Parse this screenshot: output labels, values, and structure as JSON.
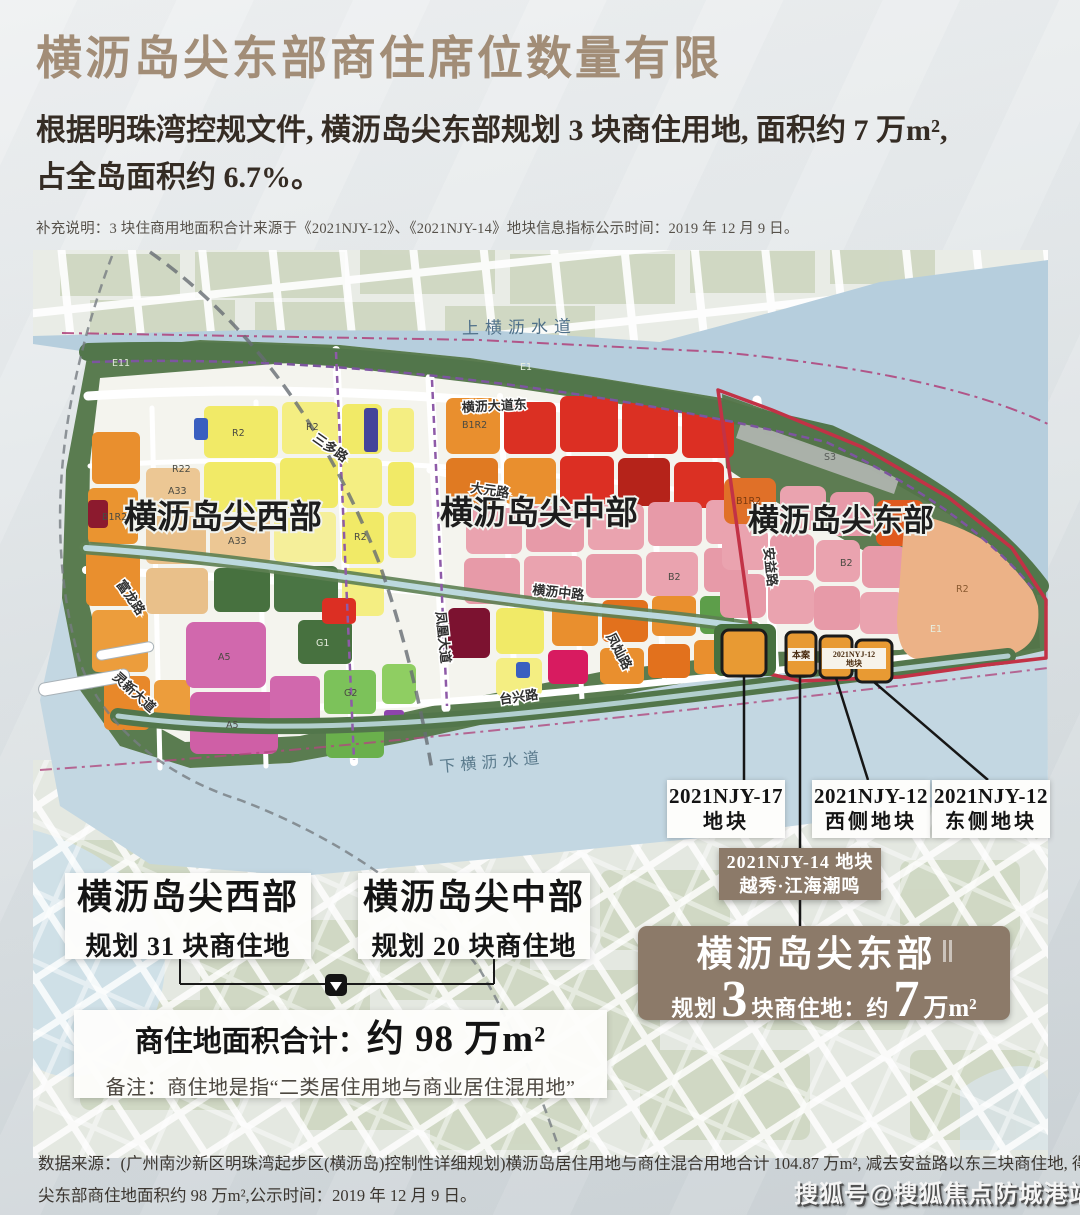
{
  "header": {
    "title": "横沥岛尖东部商住席位数量有限",
    "subtitle_line1": "根据明珠湾控规文件, 横沥岛尖东部规划 3 块商住用地, 面积约 7 万m²,",
    "subtitle_line2": "占全岛面积约 6.7%。",
    "note": "补充说明：3 块住商用地面积合计来源于《2021NJY-12》、《2021NJY-14》地块信息指标公示时间：2019 年 12 月 9 日。"
  },
  "map": {
    "waterway_top": "上横沥水道",
    "waterway_bottom": "下横沥水道",
    "region_west": "横沥岛尖西部",
    "region_middle": "横沥岛尖中部",
    "region_east": "横沥岛尖东部",
    "roads": {
      "hengli_dadao_e": "横沥大道东",
      "sanduo": "三多路",
      "dayuan": "大元路",
      "hengli_zhong": "横沥中路",
      "fengcan": "凤灿路",
      "taixing": "台兴路",
      "anyi": "安益路",
      "fulong": "富龙路",
      "lingxin": "灵新大道",
      "fenghuang": "凤凰大道"
    },
    "plot_tag_benan": "本案",
    "plot_tag_njy12_line1": "2021NYJ-12",
    "plot_tag_njy12_line2": "地块",
    "codes": [
      "R2",
      "A33",
      "B1R2",
      "G1",
      "E1",
      "A5",
      "R22",
      "G2",
      "B2",
      "S3",
      "E11"
    ]
  },
  "callouts": {
    "njy17_line1": "2021NJY-17",
    "njy17_line2": "地块",
    "njy12w_line1": "2021NJY-12",
    "njy12w_line2": "西侧地块",
    "njy12e_line1": "2021NJY-12",
    "njy12e_line2": "东侧地块",
    "njy14_line1": "2021NJY-14 地块",
    "njy14_line2": "越秀·江海潮鸣"
  },
  "summary": {
    "west_title": "横沥岛尖西部",
    "west_sub": "规划 31 块商住地",
    "middle_title": "横沥岛尖中部",
    "middle_sub": "规划 20 块商住地",
    "total_label": "商住地面积合计：",
    "total_value": "约 98 万m²",
    "total_note": "备注：商住地是指“二类居住用地与商业居住混用地”",
    "east_title": "横沥岛尖东部",
    "east_seg1": "规划",
    "east_num1": "3",
    "east_seg2": "块商住地：约",
    "east_num2": "7",
    "east_seg3": "万m²"
  },
  "footer": {
    "source_line1": "数据来源：(广州南沙新区明珠湾起步区(横沥岛)控制性详细规划)横沥岛居住用地与商住混合用地合计 104.87 万m², 减去安益路以东三块商住地, 得横沥岛尖西部与横沥岛",
    "source_line2": "尖东部商住地面积约 98 万m²,公示时间：2019 年 12 月 9 日。",
    "watermark": "搜狐号@搜狐焦点防城港站"
  }
}
